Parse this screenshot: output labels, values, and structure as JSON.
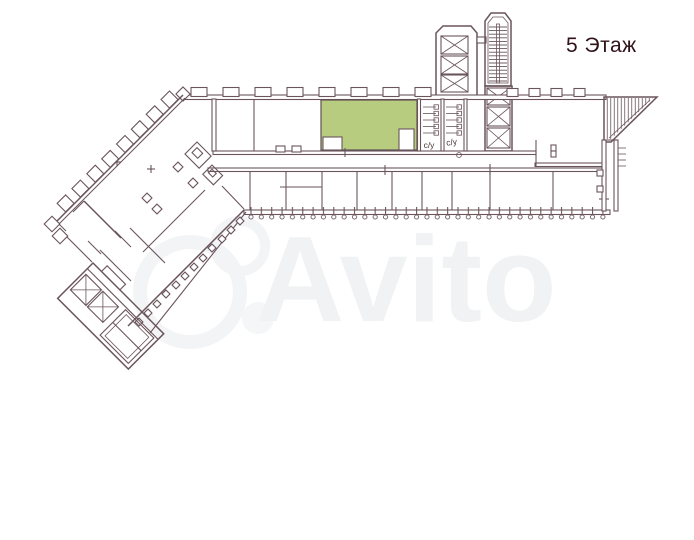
{
  "page": {
    "background_color": "#ffffff"
  },
  "header": {
    "floor_label": "5 Этаж",
    "text_color": "#30121a"
  },
  "floor_plan": {
    "line_color": "#6a555b",
    "highlighted_room": {
      "fill_color": "#b8cc80"
    },
    "bathrooms": {
      "left_label": "с/у",
      "right_label": "с/у"
    },
    "features": [
      "elevator-icon",
      "stairs-icon",
      "corridor",
      "colonnade",
      "column-marks"
    ]
  },
  "watermark": {
    "text": "Avito",
    "color": "#f0f2f3"
  }
}
